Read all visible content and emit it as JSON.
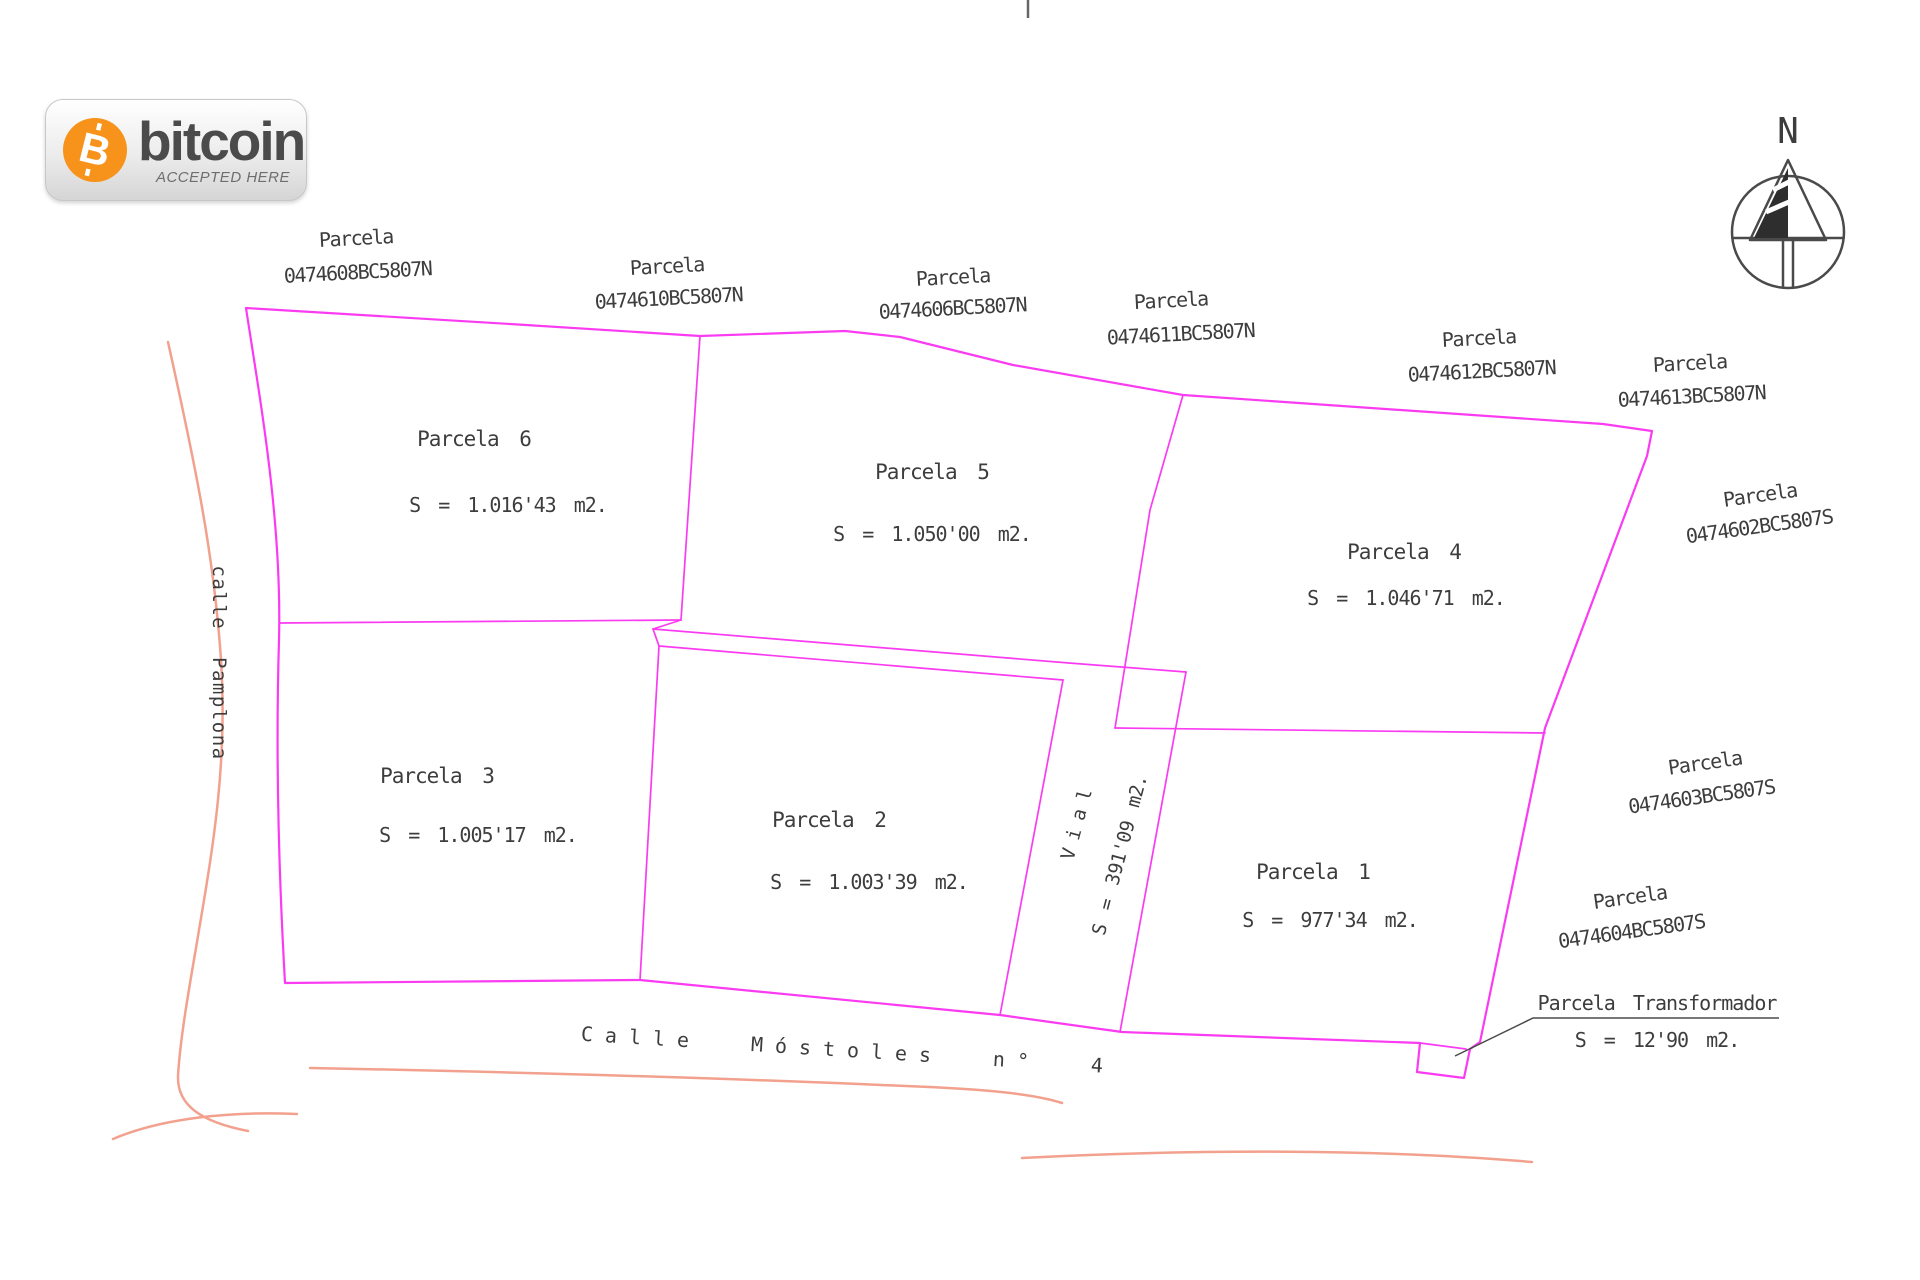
{
  "colors": {
    "parcel_line": "#fa3bf2",
    "road_line": "#f2a18e",
    "text": "#3d3d3d",
    "bitcoin_orange": "#f7931a"
  },
  "compass": {
    "label": "N"
  },
  "badge": {
    "brand": "bitcoin",
    "tagline": "ACCEPTED HERE",
    "symbol": "B"
  },
  "streets": {
    "left": "calle Pamplona",
    "bottom": "Calle Móstoles n° 4"
  },
  "cadastral_refs": [
    {
      "title": "Parcela",
      "code": "0474608BC5807N"
    },
    {
      "title": "Parcela",
      "code": "0474610BC5807N"
    },
    {
      "title": "Parcela",
      "code": "0474606BC5807N"
    },
    {
      "title": "Parcela",
      "code": "0474611BC5807N"
    },
    {
      "title": "Parcela",
      "code": "0474612BC5807N"
    },
    {
      "title": "Parcela",
      "code": "0474613BC5807N"
    },
    {
      "title": "Parcela",
      "code": "0474602BC5807S"
    },
    {
      "title": "Parcela",
      "code": "0474603BC5807S"
    },
    {
      "title": "Parcela",
      "code": "0474604BC5807S"
    }
  ],
  "parcels": [
    {
      "name": "Parcela 6",
      "area": "S = 1.016'43 m2."
    },
    {
      "name": "Parcela 5",
      "area": "S = 1.050'00 m2."
    },
    {
      "name": "Parcela 4",
      "area": "S = 1.046'71 m2."
    },
    {
      "name": "Parcela 3",
      "area": "S = 1.005'17 m2."
    },
    {
      "name": "Parcela 2",
      "area": "S = 1.003'39 m2."
    },
    {
      "name": "Parcela 1",
      "area": "S = 977'34 m2."
    }
  ],
  "vial": {
    "name": "Vial",
    "area": "S = 391'09 m2."
  },
  "transformer": {
    "name": "Parcela Transformador",
    "area": "S = 12'90 m2."
  }
}
